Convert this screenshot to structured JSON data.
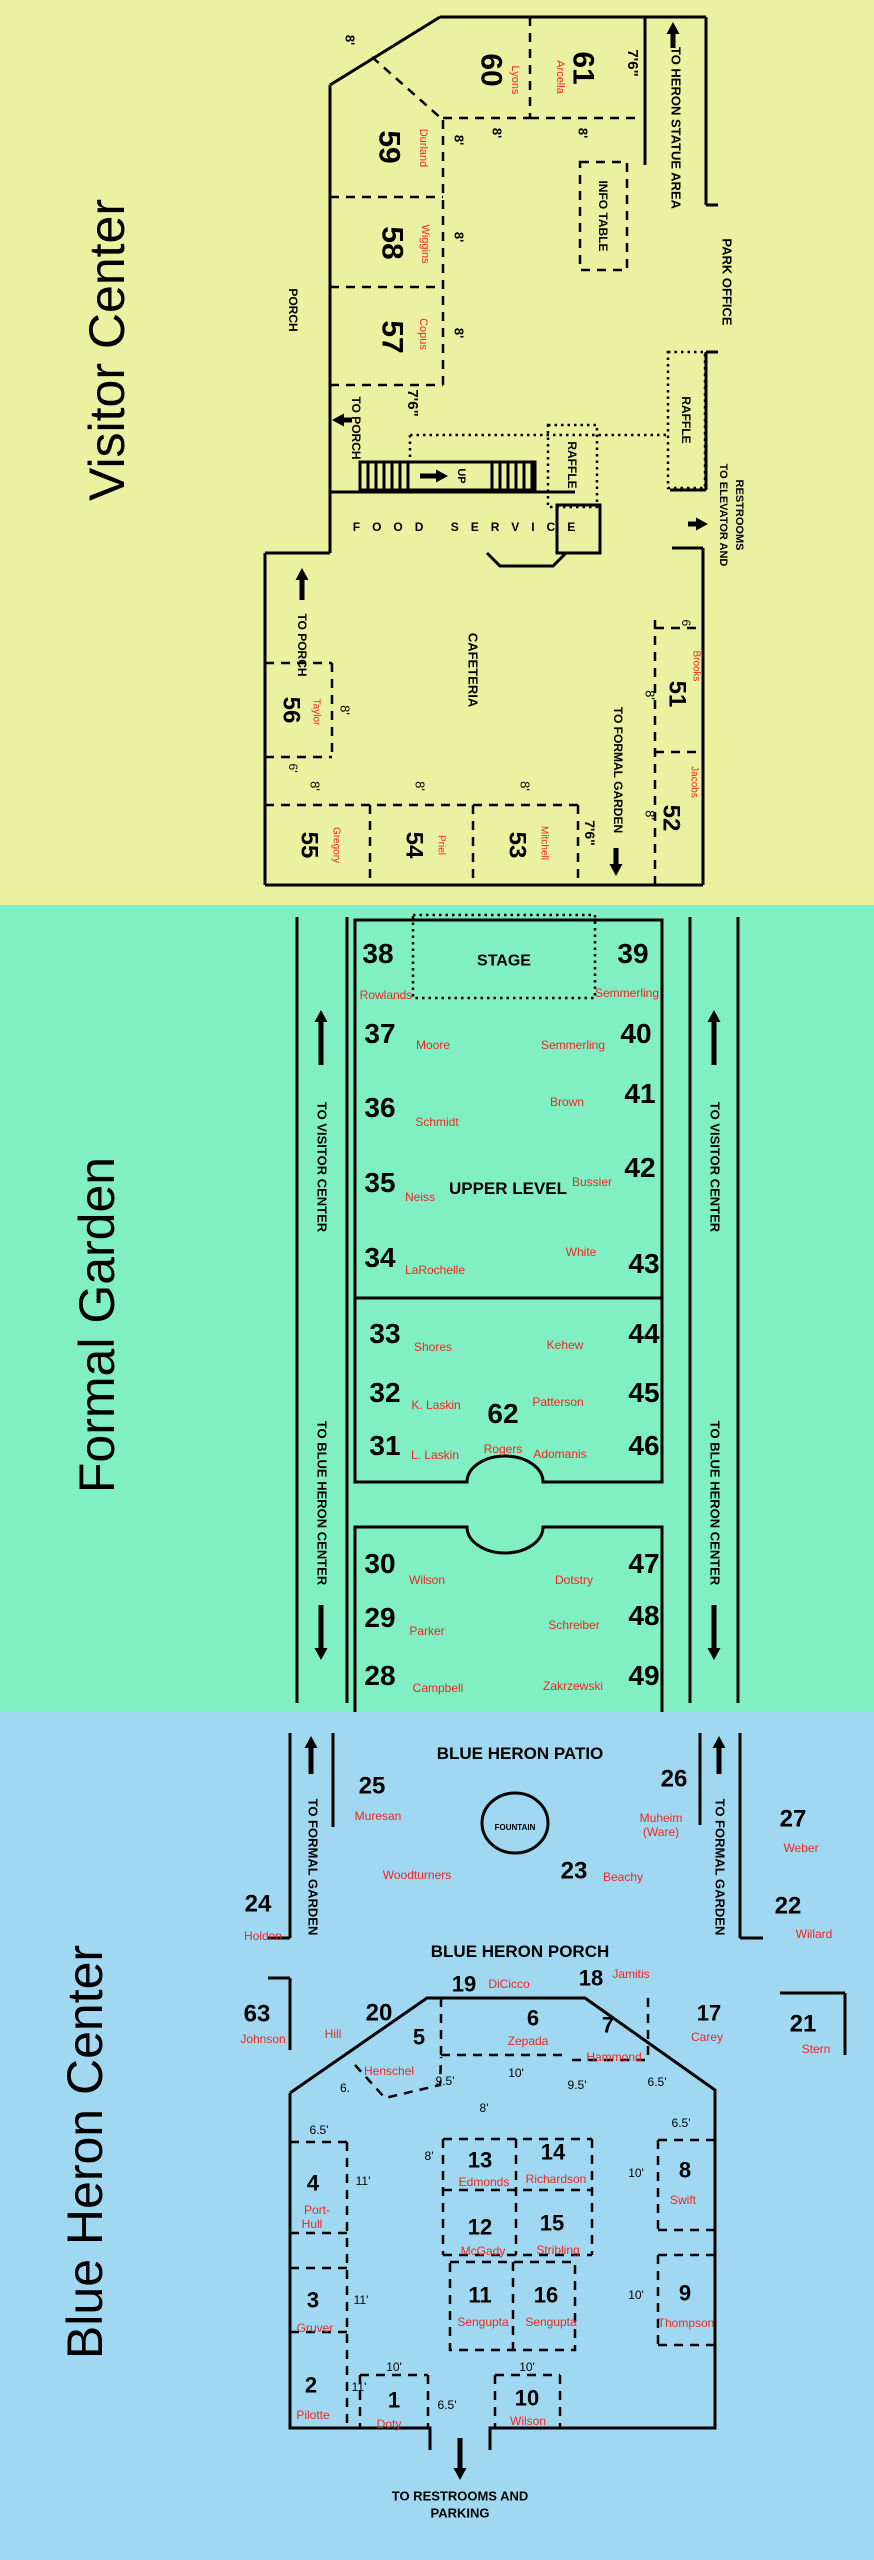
{
  "colors": {
    "yellow_bg": "#EAF2A2",
    "green_bg": "#80EFC4",
    "blue_bg": "#A0D8F2",
    "booth_name_red": "#F3261F",
    "line_black": "#000000"
  },
  "visitor_center": {
    "title": "Visitor Center",
    "booths": [
      {
        "num": "51",
        "name": "Brooks"
      },
      {
        "num": "52",
        "name": "Jacobs"
      },
      {
        "num": "53",
        "name": "Mitchell"
      },
      {
        "num": "54",
        "name": "Priel"
      },
      {
        "num": "55",
        "name": "Gregory"
      },
      {
        "num": "56",
        "name": "Taylor"
      },
      {
        "num": "57",
        "name": "Copus"
      },
      {
        "num": "58",
        "name": "Wiggins"
      },
      {
        "num": "59",
        "name": "Durland"
      },
      {
        "num": "60",
        "name": "Lyons"
      },
      {
        "num": "61",
        "name": "Arcella"
      }
    ],
    "labels": {
      "porch": "PORCH",
      "to_porch": "TO PORCH",
      "up": "UP",
      "food_service": "FOOD SERVICE",
      "raffle": "RAFFLE",
      "info_table": "INFO TABLE",
      "to_heron": "TO HERON STATUE AREA",
      "park_office": "PARK OFFICE",
      "to_elevator1": "TO ELEVATOR AND",
      "to_elevator2": "RESTROOMS",
      "cafeteria": "CAFETERIA",
      "to_formal_garden": "TO FORMAL GARDEN"
    }
  },
  "formal_garden": {
    "title": "Formal Garden",
    "booths": [
      {
        "num": "28",
        "name": "Campbell"
      },
      {
        "num": "29",
        "name": "Parker"
      },
      {
        "num": "30",
        "name": "Wilson"
      },
      {
        "num": "31",
        "name": "L. Laskin"
      },
      {
        "num": "32",
        "name": "K. Laskin"
      },
      {
        "num": "33",
        "name": "Shores"
      },
      {
        "num": "34",
        "name": "LaRochelle"
      },
      {
        "num": "35",
        "name": "Neiss"
      },
      {
        "num": "36",
        "name": "Schmidt"
      },
      {
        "num": "37",
        "name": "Moore"
      },
      {
        "num": "38",
        "name": "Rowlands"
      },
      {
        "num": "39",
        "name": "Semmerling"
      },
      {
        "num": "40",
        "name": "Semmerling"
      },
      {
        "num": "41",
        "name": "Brown"
      },
      {
        "num": "42",
        "name": "Bussler"
      },
      {
        "num": "43",
        "name": "White"
      },
      {
        "num": "44",
        "name": "Kehew"
      },
      {
        "num": "45",
        "name": "Patterson"
      },
      {
        "num": "46",
        "name": "Adomanis"
      },
      {
        "num": "47",
        "name": "Dotstry"
      },
      {
        "num": "48",
        "name": "Schreiber"
      },
      {
        "num": "49",
        "name": "Zakrzewski"
      },
      {
        "num": "62",
        "name": "Rogers"
      }
    ],
    "labels": {
      "stage": "STAGE",
      "upper_level": "UPPER LEVEL",
      "to_visitor": "TO VISITOR CENTER",
      "to_blue_heron": "TO BLUE HERON CENTER"
    }
  },
  "blue_heron_center": {
    "title": "Blue Heron Center",
    "booths": [
      {
        "num": "1",
        "name": "Doty"
      },
      {
        "num": "2",
        "name": "Pilotte"
      },
      {
        "num": "3",
        "name": "Gruver"
      },
      {
        "num": "4",
        "name": "Port-",
        "name2": "Hull"
      },
      {
        "num": "5",
        "name": "Henschel"
      },
      {
        "num": "6",
        "name": "Zepada"
      },
      {
        "num": "7",
        "name": "Hammond"
      },
      {
        "num": "8",
        "name": "Swift"
      },
      {
        "num": "9",
        "name": "Thompson"
      },
      {
        "num": "10",
        "name": "Wilson"
      },
      {
        "num": "11",
        "name": "Sengupta"
      },
      {
        "num": "12",
        "name": "McGady"
      },
      {
        "num": "13",
        "name": "Edmonds"
      },
      {
        "num": "14",
        "name": "Richardson"
      },
      {
        "num": "15",
        "name": "Stribling"
      },
      {
        "num": "16",
        "name": "Sengupta"
      },
      {
        "num": "17",
        "name": "Carey"
      },
      {
        "num": "18",
        "name": "Jamitis"
      },
      {
        "num": "19",
        "name": "DiCicco"
      },
      {
        "num": "20",
        "name": "Hill"
      },
      {
        "num": "21",
        "name": "Stern"
      },
      {
        "num": "22",
        "name": "Willard"
      },
      {
        "num": "23",
        "name": "Beachy"
      },
      {
        "num": "24",
        "name": "Holden"
      },
      {
        "num": "25",
        "name": "Muresan"
      },
      {
        "num": "26",
        "name": "Muheim",
        "name2": "(Ware)"
      },
      {
        "num": "27",
        "name": "Weber"
      },
      {
        "num": "63",
        "name": "Johnson"
      }
    ],
    "labels": {
      "patio": "BLUE HERON PATIO",
      "porch": "BLUE HERON PORCH",
      "fountain": "FOUNTAIN",
      "woodturners": "Woodturners",
      "to_formal_garden": "TO FORMAL GARDEN",
      "to_restrooms1": "TO RESTROOMS AND",
      "to_restrooms2": "PARKING"
    }
  },
  "dims": {
    "d6": "6'",
    "d6dot": "6.",
    "d65": "6.5'",
    "d8": "8'",
    "d95": "9.5'",
    "d10": "10'",
    "d11": "11'",
    "d76": "7'6\""
  }
}
